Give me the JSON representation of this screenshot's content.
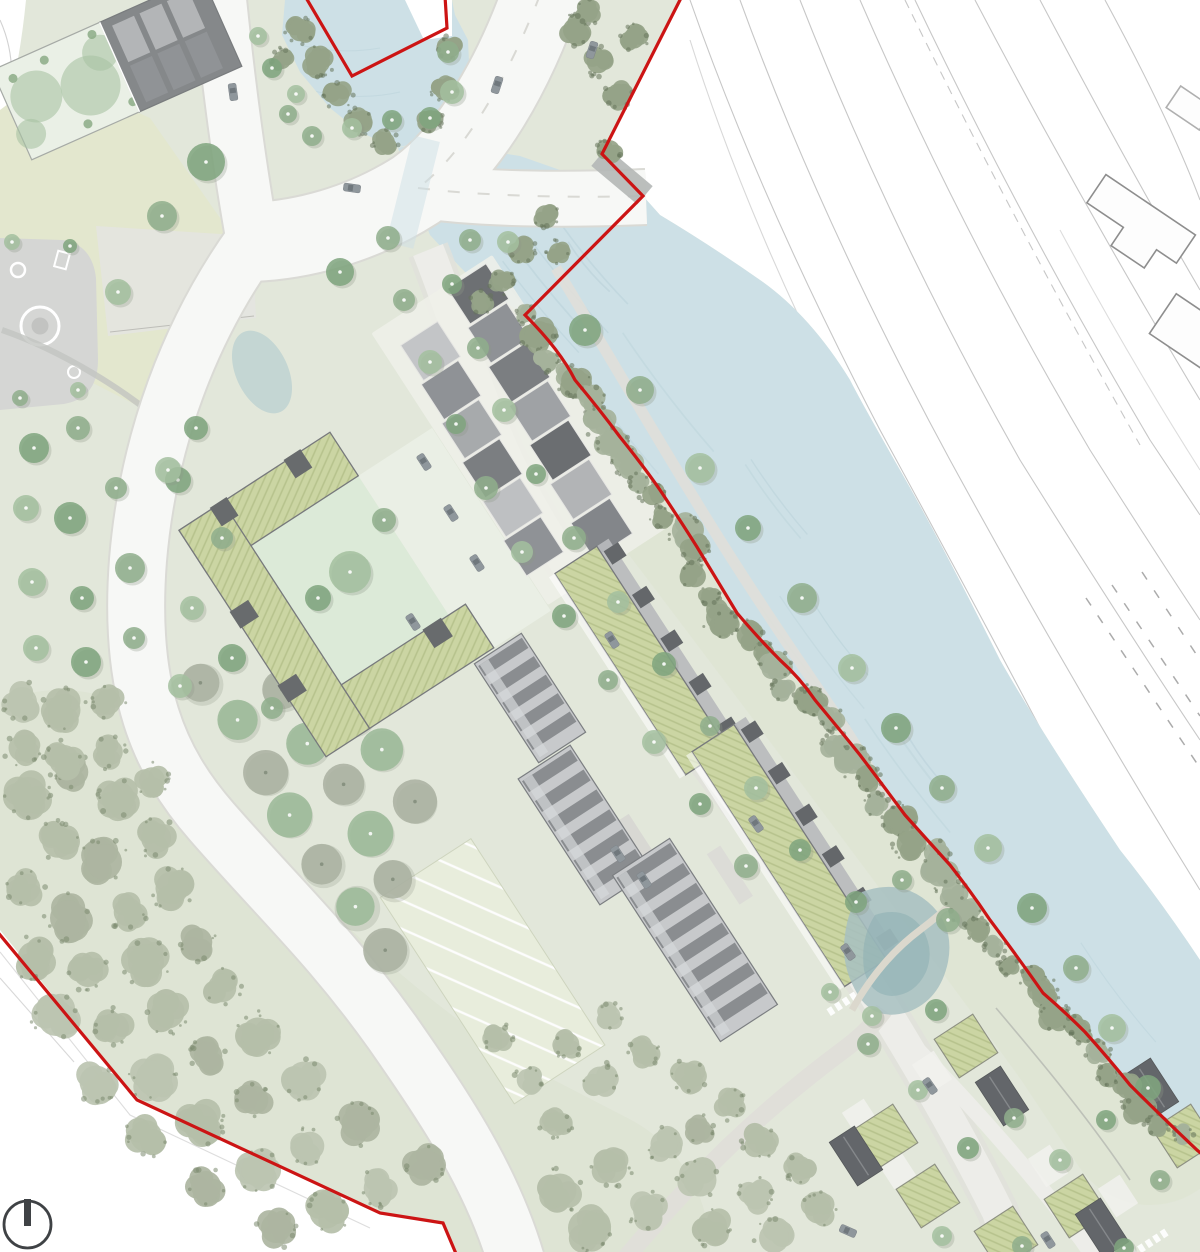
{
  "page": {
    "title": "Riverside masterplan site plan",
    "type": "architectural-landscape-site-plan"
  },
  "palette": {
    "site_green": "#e2e7da",
    "lawn_yellow": "#e3e7c9",
    "meadow": "#dde4d0",
    "wood_floor": "#d9e0cc",
    "water": "#cde0e6",
    "water_wave": "#b9d1d9",
    "context_white": "#ffffff",
    "context_line": "#c7c7c7",
    "context_building_line": "#8e8e8e",
    "boundary_red": "#cc1414",
    "road_white": "#f7f8f6",
    "road_casing": "#dadad5",
    "street_gray": "#edede9",
    "street_casing": "#e1e1db",
    "path_gray": "#e0dfd9",
    "plaza_gray": "#e4e4e0",
    "playground_gray": "#d5d6d4",
    "roof_green": "#cbd5a3",
    "roof_green_hatch": "#b6c28c",
    "roof_dark": "#696c6f",
    "roof_mid": "#8f9295",
    "roof_light": "#b6b8ba",
    "roof_pale": "#d3d5d7",
    "building_edge": "#77797c",
    "courtyard_green": "#dcead8",
    "court_pale": "#eaf0e6",
    "tree_street": "#7fa57e",
    "tree_street_light": "#a3bf9f",
    "tree_park": "#8fae8c",
    "tree_wood": "#b5bfa9",
    "tree_wood_dark": "#7b8a6f",
    "tree_river": "#95a388",
    "tree_river_dark": "#66755b",
    "orchard_sage": "#9cba98",
    "orchard_gray": "#abb2a2",
    "allot_bg": "#e9eedd",
    "pond": "#a7c0c1",
    "pond_deep": "#8fb0b4",
    "car_body": "#8f979c",
    "car_glass": "#6d747a",
    "jetty": "#b4b7b6",
    "north": "#3f4245"
  },
  "legend": {
    "features": [
      {
        "id": "site-boundary-red-line"
      },
      {
        "id": "river"
      },
      {
        "id": "upstream-pond"
      },
      {
        "id": "context-area-white-linework"
      },
      {
        "id": "main-road-junction"
      },
      {
        "id": "river-bridge-crossing"
      },
      {
        "id": "development-street"
      },
      {
        "id": "loop-road"
      },
      {
        "id": "green-roof-courtyard-building"
      },
      {
        "id": "row-houses"
      },
      {
        "id": "riverside-terrace-buildings"
      },
      {
        "id": "barn-buildings"
      },
      {
        "id": "allotment-gardens"
      },
      {
        "id": "orchard"
      },
      {
        "id": "woodland"
      },
      {
        "id": "riverside-tree-belt"
      },
      {
        "id": "wetland-pond"
      },
      {
        "id": "playground"
      },
      {
        "id": "north-arrow"
      }
    ]
  },
  "compass": {
    "symbol": "circle-with-north-bar",
    "label": "N"
  }
}
